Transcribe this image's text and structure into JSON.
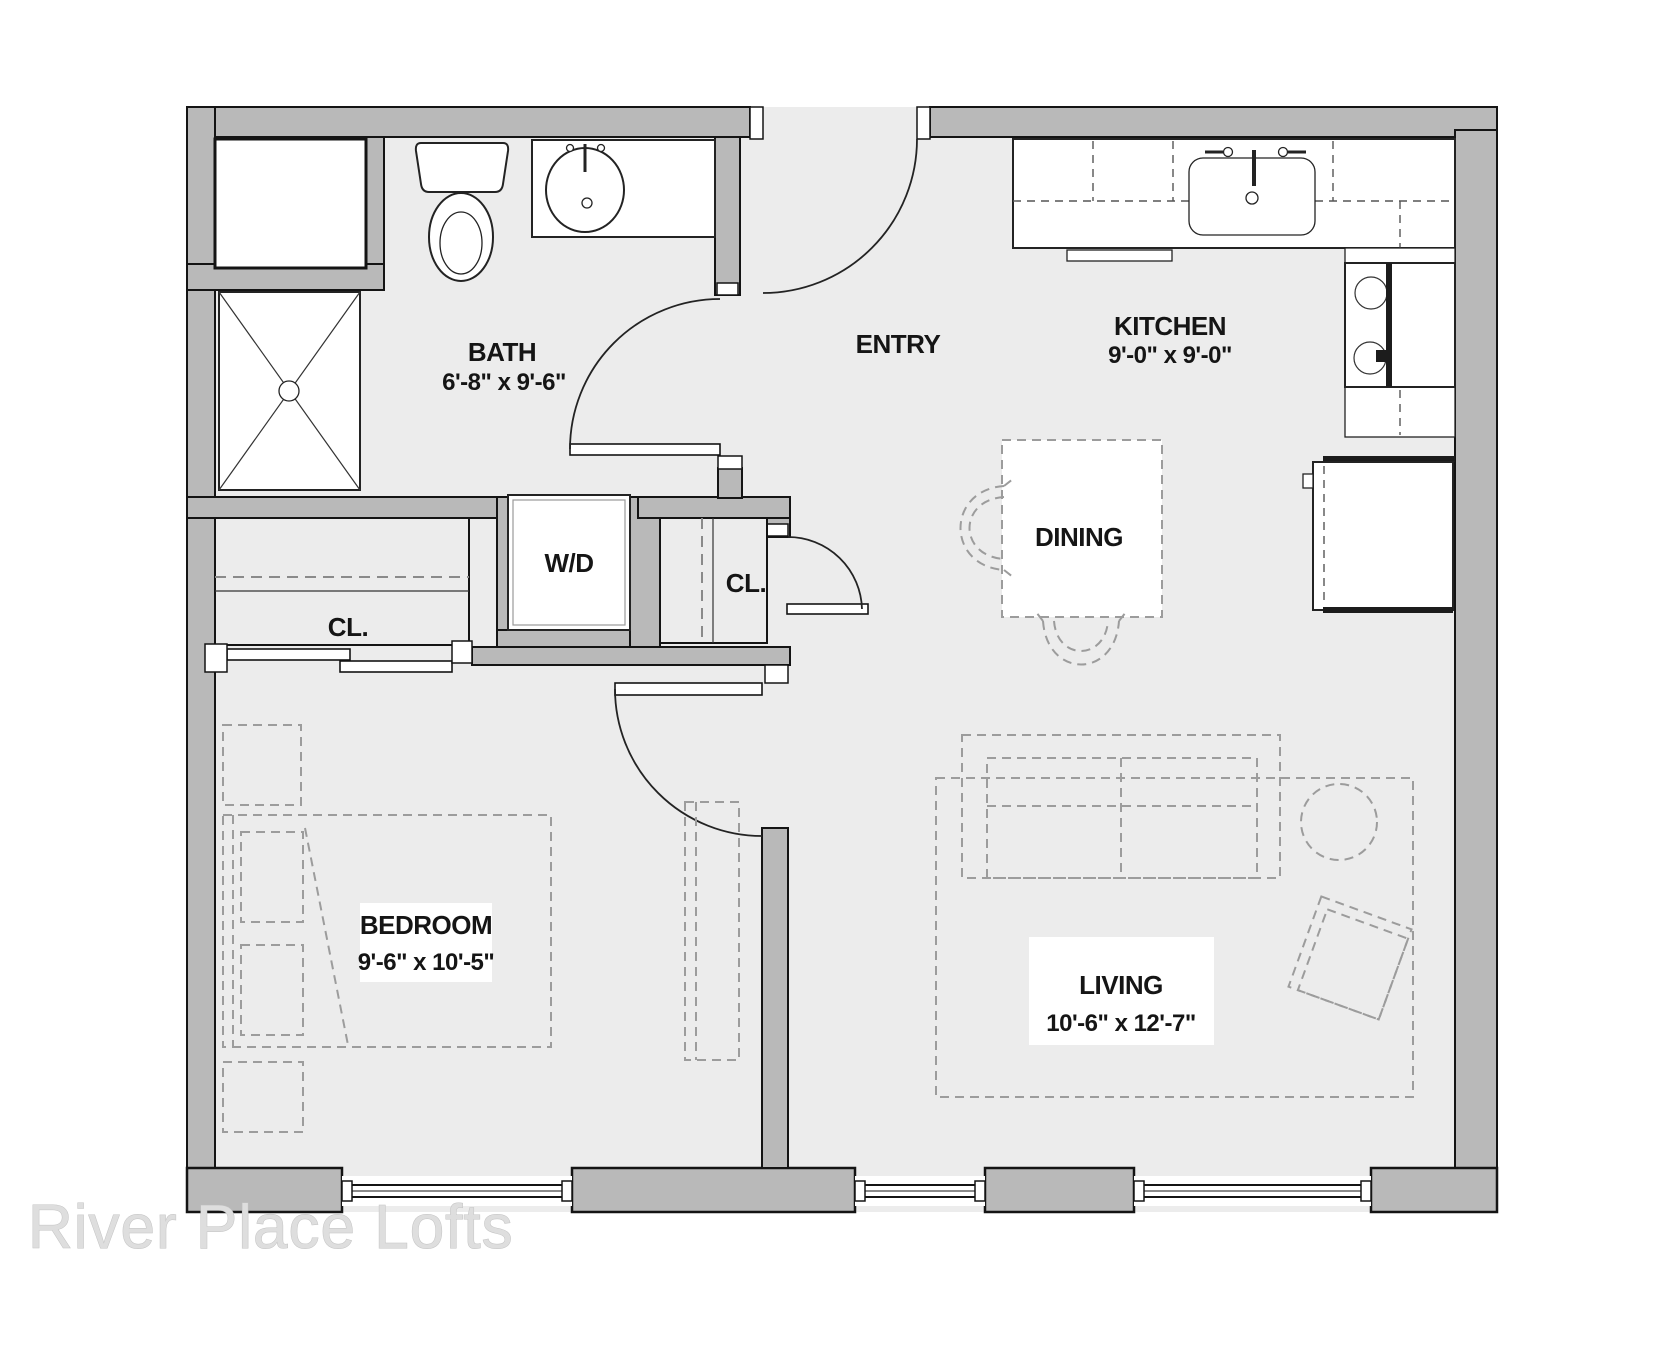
{
  "watermark": "River Place Lofts",
  "rooms": {
    "bath": {
      "label": "BATH",
      "dims": "6'-8\" x 9'-6\""
    },
    "entry": {
      "label": "ENTRY"
    },
    "kitchen": {
      "label": "KITCHEN",
      "dims": "9'-0\" x 9'-0\""
    },
    "dining": {
      "label": "DINING"
    },
    "laundry": {
      "label": "W/D"
    },
    "closet1": {
      "label": "CL."
    },
    "closet2": {
      "label": "CL."
    },
    "bedroom": {
      "label": "BEDROOM",
      "dims": "9'-6\" x 10'-5\""
    },
    "living": {
      "label": "LIVING",
      "dims": "10'-6\" x 12'-7\""
    }
  },
  "colors": {
    "wall": "#b9b9b9",
    "floor": "#ececec",
    "line": "#1a1a1a",
    "furniture_dash": "#9c9c9c",
    "watermark": "#dedede"
  }
}
